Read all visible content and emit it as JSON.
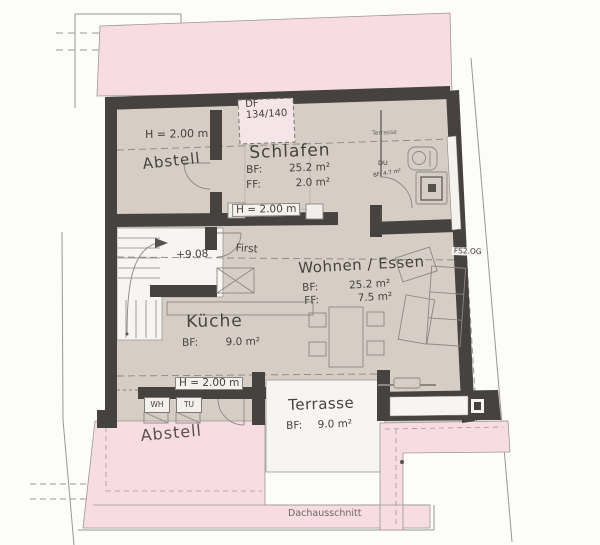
{
  "colors": {
    "roof_pink": "#f7dde3",
    "floor_beige": "#d6cec5",
    "wall_dark": "#454240",
    "room_white": "#f6f5f1",
    "line_grey": "#8b8783"
  },
  "rooms": {
    "abstell_top": {
      "name": "Abstell"
    },
    "schlafen": {
      "name": "Schlafen",
      "bf_label": "BF:",
      "bf_value": "25.2 m²",
      "ff_label": "FF:",
      "ff_value": "2.0 m²"
    },
    "dusche": {
      "name": "DU",
      "area": "BF: 4.7 m²"
    },
    "wohnen": {
      "name": "Wohnen / Essen",
      "bf_label": "BF:",
      "bf_value": "25.2 m²",
      "ff_label": "FF:",
      "ff_value": "7.5 m²"
    },
    "kueche": {
      "name": "Küche",
      "bf_label": "BF:",
      "bf_value": "9.0 m²"
    },
    "terrasse": {
      "name": "Terrasse",
      "bf_label": "BF:",
      "bf_value": "9.0 m²"
    },
    "terrasse_top_small": {
      "name": "Terrasse"
    },
    "abstell_bottom": {
      "name": "Abstell"
    },
    "dachausschnitt": {
      "name": "Dachausschnitt"
    }
  },
  "annotations": {
    "roof_window_type": "DF",
    "roof_window_size": "134/140",
    "height_top": "H = 2.00 m",
    "height_mid": "H = 2.00 m",
    "height_bottom": "H = 2.00 m",
    "level": "+9.08",
    "ridge": "First",
    "ref": "FS2.OG",
    "washer": "WH",
    "dryer": "TU"
  }
}
